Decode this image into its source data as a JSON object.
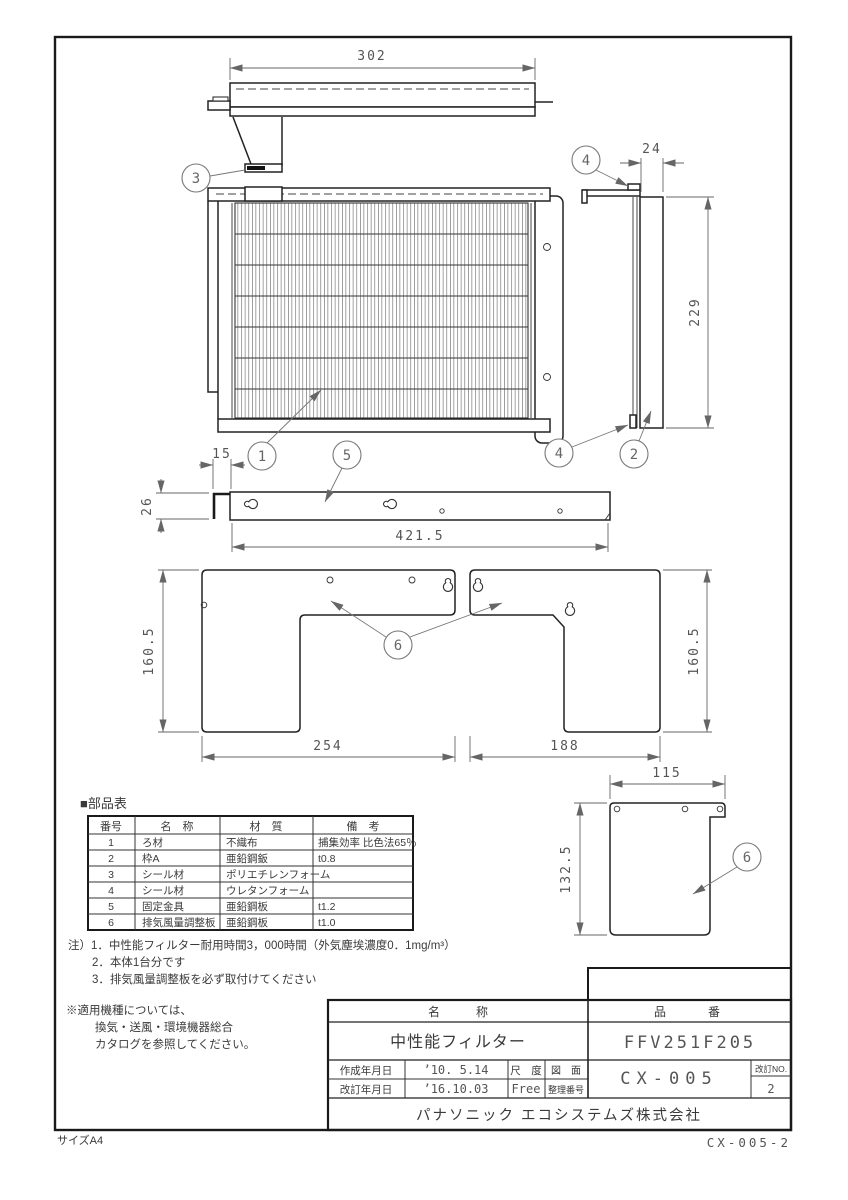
{
  "page": {
    "size_label": "サイズA4",
    "doc_number": "CX-005-2"
  },
  "balloons": {
    "b1": "1",
    "b2": "2",
    "b3": "3",
    "b4": "4",
    "b5": "5",
    "b6": "6"
  },
  "dimensions": {
    "top_width": "302",
    "side_depth": "24",
    "side_height": "229",
    "angle_width": "15",
    "angle_height": "26",
    "bar_length": "421.5",
    "plate_left_height": "160.5",
    "plate_left_width": "254",
    "plate_right_width": "188",
    "plate_right_height": "160.5",
    "small_plate_width": "115",
    "small_plate_height": "132.5"
  },
  "parts_table": {
    "title": "■部品表",
    "headers": [
      "番号",
      "名　称",
      "材　質",
      "備　考"
    ],
    "rows": [
      [
        "1",
        "ろ材",
        "不織布",
        "捕集効率 比色法65％"
      ],
      [
        "2",
        "枠A",
        "亜鉛鋼鈑",
        "t0.8"
      ],
      [
        "3",
        "シール材",
        "ポリエチレンフォーム",
        ""
      ],
      [
        "4",
        "シール材",
        "ウレタンフォーム",
        ""
      ],
      [
        "5",
        "固定金具",
        "亜鉛鋼板",
        "t1.2"
      ],
      [
        "6",
        "排気風量調整板",
        "亜鉛鋼板",
        "t1.0"
      ]
    ]
  },
  "notes": {
    "note1": "注）1．中性能フィルター耐用時間3，000時間（外気塵埃濃度0．1mg/m³）",
    "note2": "2．本体1台分です",
    "note3": "3．排気風量調整板を必ず取付けてください",
    "usage1": "※適用機種については、",
    "usage2": "換気・送風・環境機器総合",
    "usage3": "カタログを参照してください。"
  },
  "title_block": {
    "name_label": "名　　　称",
    "name_value": "中性能フィルター",
    "part_label": "品　　番",
    "part_value": "FFV251F205",
    "created_label": "作成年月日",
    "created_value": "’10.  5.14",
    "revised_label": "改訂年月日",
    "revised_value": "’16.10.03",
    "scale_label": "尺　度",
    "scale_value": "Free",
    "drawing_label": "図　面",
    "ref_label": "整理番号",
    "drawing_number": "CX-005",
    "rev_label": "改訂NO.",
    "rev_value": "2",
    "company": "パナソニック エコシステムズ株式会社"
  }
}
